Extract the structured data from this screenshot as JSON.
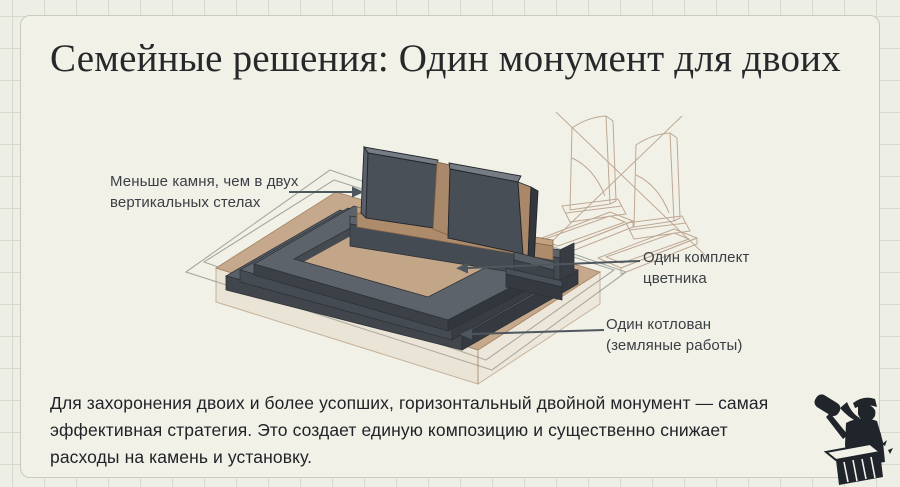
{
  "title": "Семейные решения: Один монумент для двоих",
  "annotations": {
    "less_stone": "Меньше камня, чем в двух вертикальных стелах",
    "flowerbed": "Один комплект цветника",
    "excavation": "Один котлован (земляные работы)"
  },
  "body_text": "Для захоронения двоих и более усопших, горизонтальный двойной монумент — самая эффективная стратегия. Это создает единую композицию и существенно снижает расходы на камень и установку.",
  "illustration": {
    "main": "isometric-horizontal-double-monument",
    "background_sketch": "two-vertical-steles-crossed-out",
    "colors": {
      "stone_dark": "#4a5058",
      "stone_top": "#767c84",
      "wood_tan": "#ad8b6b",
      "ground_tan": "#c6a98c",
      "outline_gray": "#a2a69e",
      "arrow": "#4e575e",
      "sketch_line": "#b59c84"
    }
  },
  "logo": {
    "icon": "stonemason-with-mallet-and-chisel",
    "color": "#20252b"
  },
  "theme": {
    "background": "#edeee5",
    "grid_line": "#d7d9cc",
    "panel": "#f2f1e8",
    "panel_border": "#c9cbbd",
    "title_color": "#26282a",
    "text_color": "#202428",
    "label_color": "#3a3f44"
  }
}
